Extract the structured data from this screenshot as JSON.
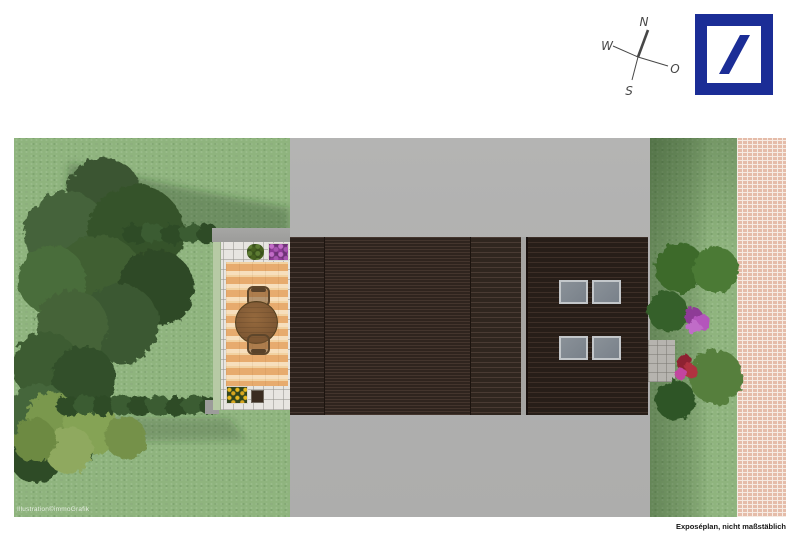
{
  "header": {
    "compass": {
      "north": "N",
      "west": "W",
      "east": "O",
      "south": "S"
    },
    "logo": {
      "icon": "deutsche-bank-slash-logo",
      "color": "#1b2d96"
    }
  },
  "footer": {
    "credit": "Illustration©immoGrafik",
    "note": "Exposéplan, nicht maßstäblich"
  },
  "plan": {
    "regions": [
      "garden-lawn-left",
      "terrace-with-seating",
      "driveway",
      "main-roof",
      "annex-roof-with-skylights",
      "green-strip-right",
      "entrance-pad",
      "paved-sidewalk"
    ]
  },
  "colors": {
    "accent_blue": "#1b2d96",
    "compass": "#474747",
    "lawn": "#8fb47e",
    "lawn_shadow": "#6e9361",
    "tree_dark": "#3e5a33",
    "hedge": "#30502a",
    "tree_yellow": "#7e9b4f",
    "driveway": "#b1b1b0",
    "wall": "#9c9c9a",
    "roof": "#372b24",
    "annex_roof": "#302620",
    "skylight": "#79818a",
    "skylight_frame": "#c3c7ca",
    "terrace_paver": "#e7e5e1",
    "deck_light": "#f3d3a7",
    "deck_dark": "#e0a368",
    "table": "#7d5733",
    "sidewalk": "#e5bca9",
    "mortar": "#f6ebe3"
  }
}
